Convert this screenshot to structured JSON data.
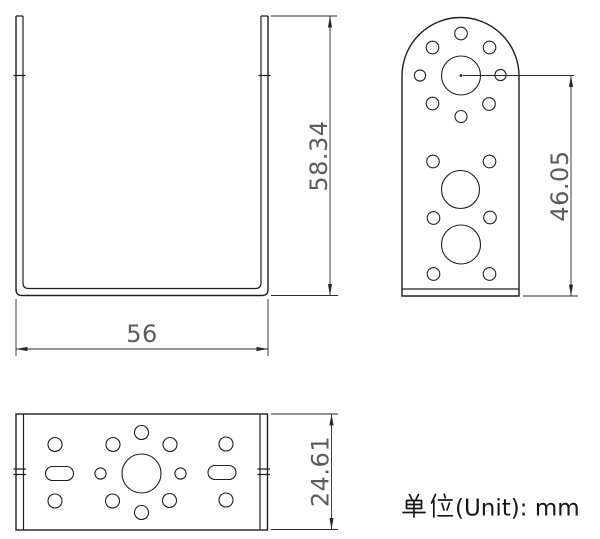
{
  "page": {
    "background": "#ffffff"
  },
  "drawing": {
    "line_color": "#1f1f1f",
    "dim_color": "#2a2a2a",
    "dim_text_color": "#5c5c5c"
  },
  "dimensions": {
    "front_height": "58.34",
    "front_width": "56",
    "side_height": "46.05",
    "top_depth": "24.61"
  },
  "unit_note": {
    "full_text": "单位(Unit)：mm",
    "cjk_text": "单位",
    "latin_display": "(Unit): mm"
  }
}
